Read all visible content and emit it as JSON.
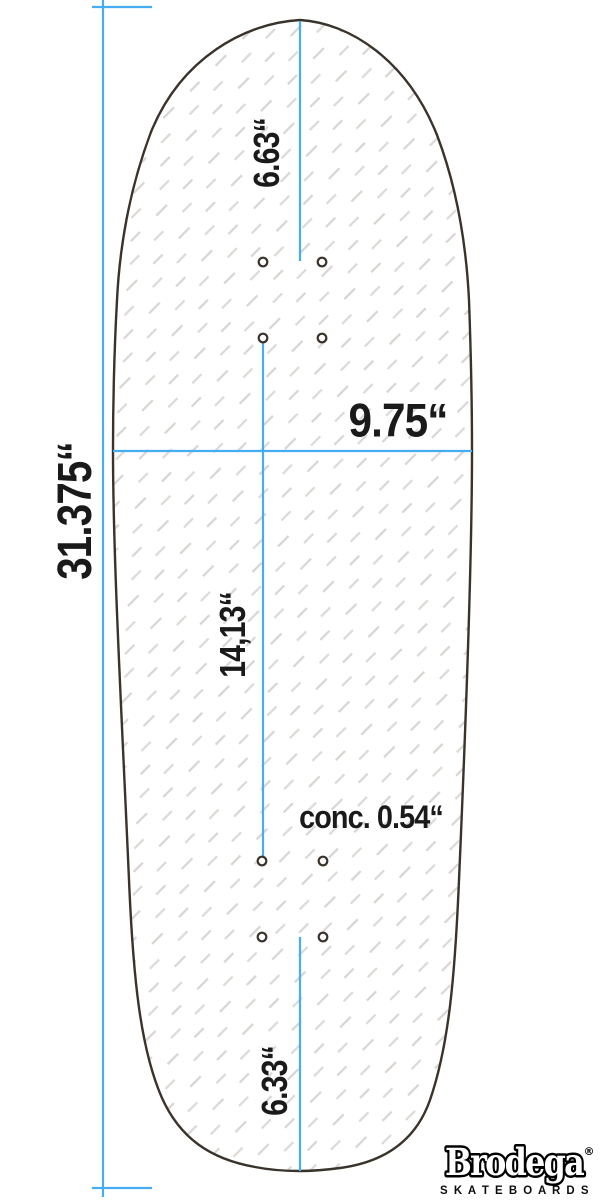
{
  "drawing": {
    "subject": "skateboard-deck-top-view",
    "dimensions": {
      "total_length": "31.375“",
      "nose_length": "6.63“",
      "width": "9.75“",
      "wheelbase": "14,13“",
      "concave": "conc. 0.54“",
      "tail_length": "6.33“"
    }
  },
  "brand": {
    "name": "Brodega",
    "registered_mark": "®",
    "subtitle": "S K A T E B O A R D S"
  },
  "colors": {
    "dimension_line_blue": "#45AEF2",
    "deck_outline": "#3A332C",
    "hatch_gray": "#D8D5D2",
    "label_text": "#1A1A1A",
    "logo_fill": "#FFFFFF",
    "logo_outline": "#000000",
    "background": "#FFFFFF"
  }
}
